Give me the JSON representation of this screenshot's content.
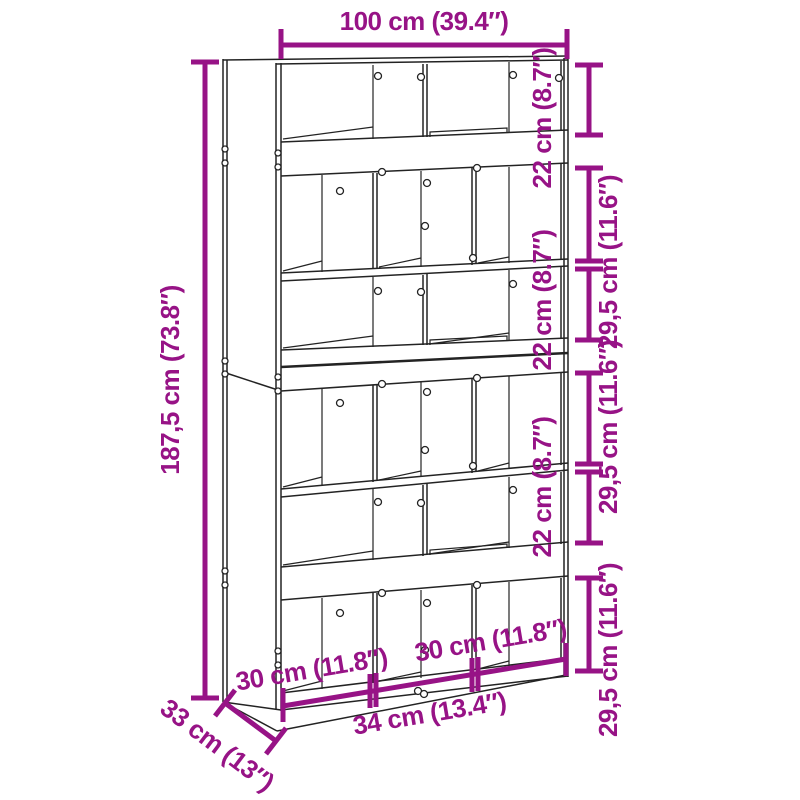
{
  "diagram": {
    "subject": "bookcase dimension drawing",
    "dims": {
      "top_width": "100 cm (39.4″)",
      "height": "187,5 cm (73.8″)",
      "right_pairs": [
        {
          "small": "22 cm (8.7″)",
          "large": "29,5 cm (11.6″)"
        },
        {
          "small": "22 cm (8.7″)",
          "large": "29,5 cm (11.6″)"
        },
        {
          "small": "22 cm (8.7″)",
          "large": "29,5 cm (11.6″)"
        }
      ],
      "bottom_left_width": "30 cm (11.8″)",
      "bottom_right_width": "30 cm (11.8″)",
      "bottom_front_width": "34 cm (13.4″)",
      "depth": "33 cm (13″)"
    },
    "colors": {
      "dimension_accent": "#971386",
      "outline": "#232323",
      "background": "#ffffff"
    }
  }
}
